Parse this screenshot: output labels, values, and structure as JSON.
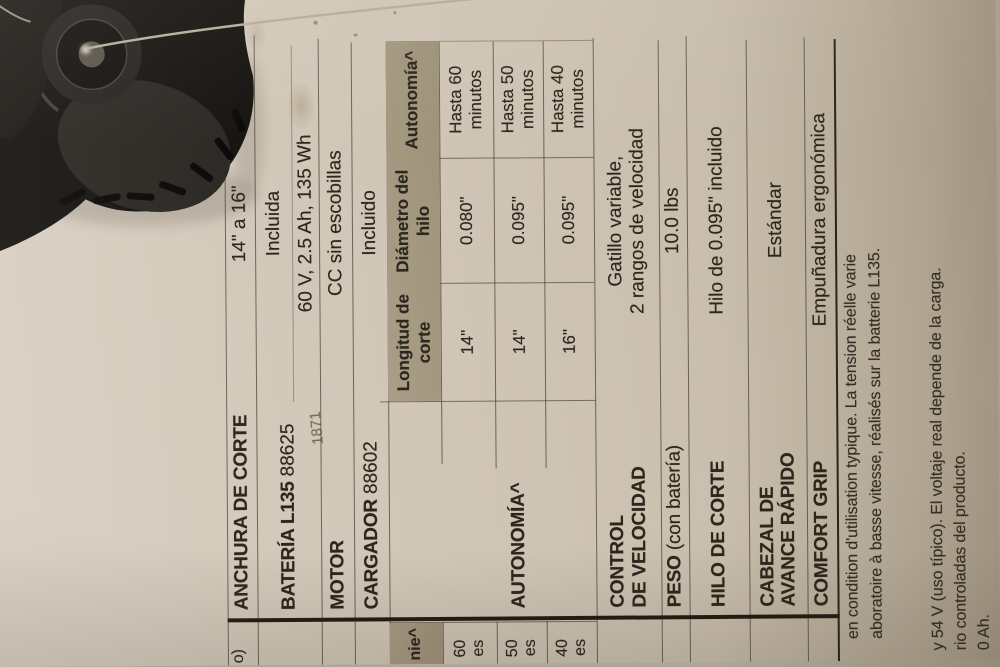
{
  "colors": {
    "cardboard": "#d0c6b7",
    "shaded_header": "#a3977f",
    "ink": "#2c261d",
    "thick_rule": "#221b12",
    "photo_black": "#15130f",
    "trimmer_line_gray": "#b6ad9e"
  },
  "photo": {
    "name": "string-trimmer-head",
    "line": "trimmer-cutting-line"
  },
  "spec_table": {
    "anchura": {
      "label": "ANCHURA DE CORTE",
      "value": "14\" a 16\""
    },
    "bateria": {
      "label": "BATERÍA L135",
      "model": "88625",
      "value1": "Incluida",
      "value2": "60 V, 2.5 Ah, 135 Wh"
    },
    "motor": {
      "label": "MOTOR",
      "value": "CC sin escobillas"
    },
    "cargador": {
      "label": "CARGADOR",
      "model": "88602",
      "value": "Incluido"
    },
    "autonomia": {
      "label": "AUTONOMÍA^"
    },
    "autonomy_table": {
      "col1_header": "Longitud de corte",
      "col2_header": "Diámetro del hilo",
      "col3_header": "Autonomía^",
      "rows": [
        {
          "longitud": "14\"",
          "diametro": "0.080\"",
          "autonomia": "Hasta 60 minutos"
        },
        {
          "longitud": "14\"",
          "diametro": "0.095\"",
          "autonomia": "Hasta 50 minutos"
        },
        {
          "longitud": "16\"",
          "diametro": "0.095\"",
          "autonomia": "Hasta 40 minutos"
        }
      ]
    },
    "control": {
      "label_line1": "CONTROL",
      "label_line2": "DE VELOCIDAD",
      "value_line1": "Gatillo variable,",
      "value_line2": "2 rangos de velocidad"
    },
    "peso": {
      "label": "PESO",
      "label_note": "(con batería)",
      "value": "10.0 lbs"
    },
    "hilo": {
      "label": "HILO DE CORTE",
      "value": "Hilo de 0.095\" incluido"
    },
    "cabezal": {
      "label_line1": "CABEZAL DE",
      "label_line2": "AVANCE RÁPIDO",
      "value": "Estándar"
    },
    "comfort": {
      "label": "COMFORT GRIP",
      "value": "Empuñadura ergonómica"
    }
  },
  "left_fragments": {
    "row1": "o)",
    "autonomy_header": "nie^",
    "r1a": "60",
    "r1b": "es",
    "r2a": "50",
    "r2b": "es",
    "r3a": "40",
    "r3b": "es"
  },
  "footnotes": {
    "fr1": "en condition d'utilisation typique. La tension réelle varie",
    "fr2": "aboratoire à basse vitesse, réalisés sur la batterie L135.",
    "es1": "y 54 V (uso típico). El voltaje real depende de la carga.",
    "es2": "rio controladas del producto.",
    "es3": "0 Ah."
  },
  "faint_mark": "1871"
}
